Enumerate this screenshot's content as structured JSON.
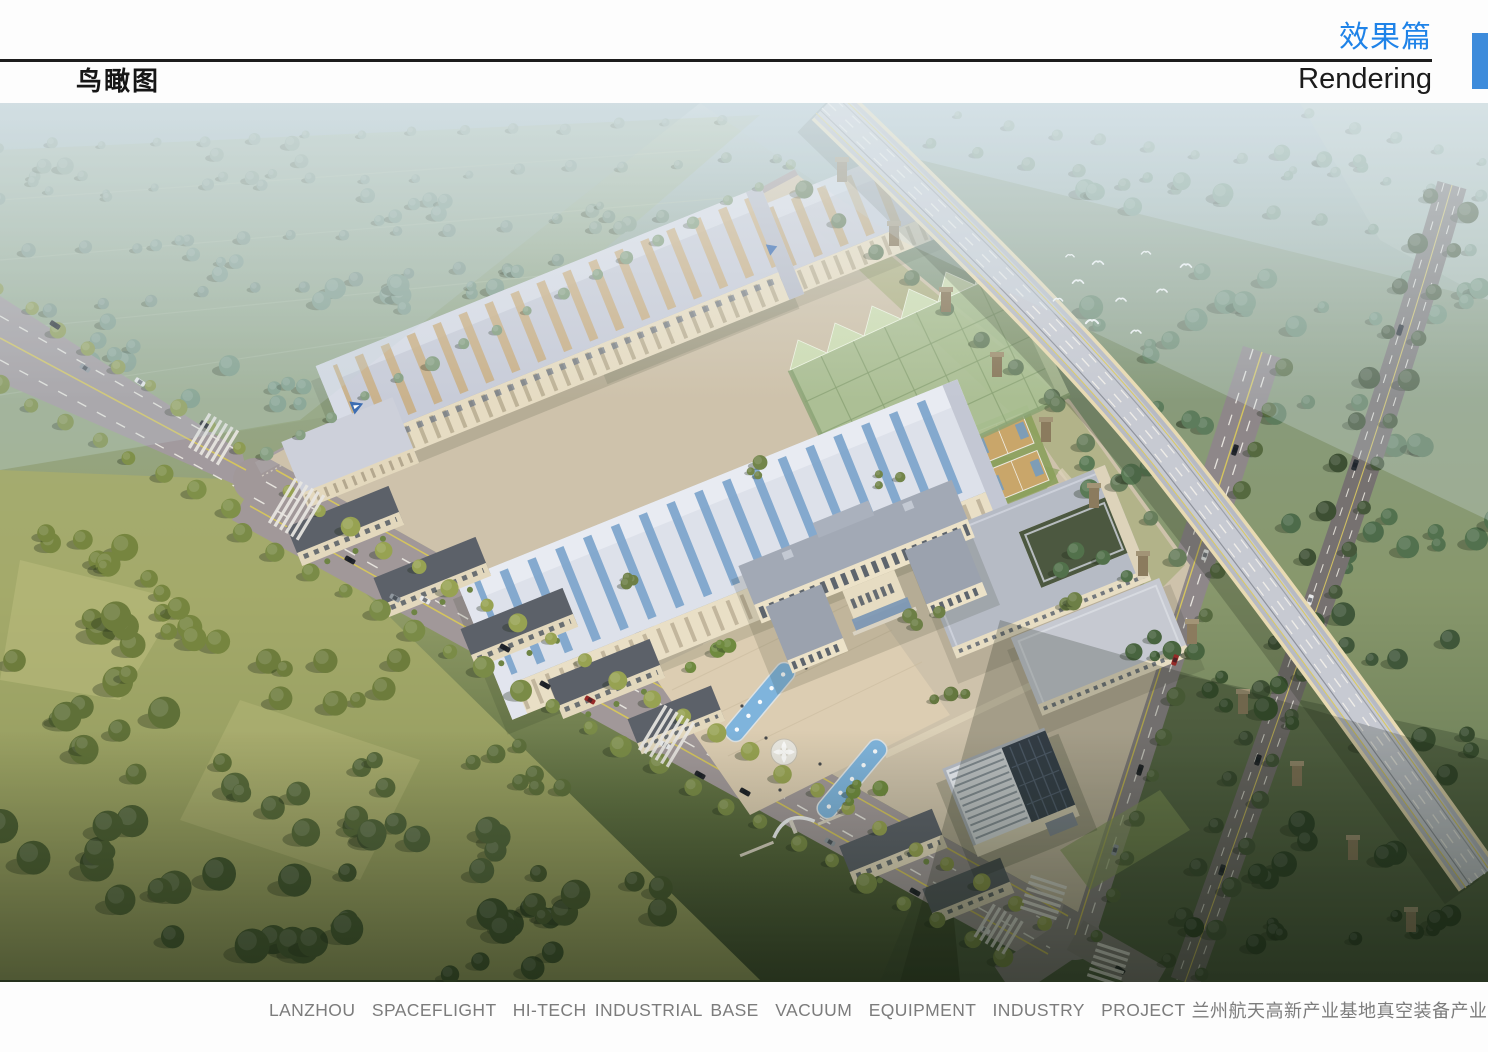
{
  "header": {
    "section_title_cn": "效果篇",
    "section_title_en": "Rendering",
    "view_title": "鸟瞰图"
  },
  "footer": {
    "caption_en": "LANZHOU  SPACEFLIGHT  HI-TECH INDUSTRIAL BASE  VACUUM  EQUIPMENT  INDUSTRY  PROJECT",
    "caption_cn": "兰州航天高新产业基地真空装备产业园项目"
  },
  "colors": {
    "accent_blue": "#3d8bdb",
    "title_blue": "#1f83e8",
    "heading_black": "#1b1b1b",
    "caption_gray": "#7c7c7c"
  }
}
